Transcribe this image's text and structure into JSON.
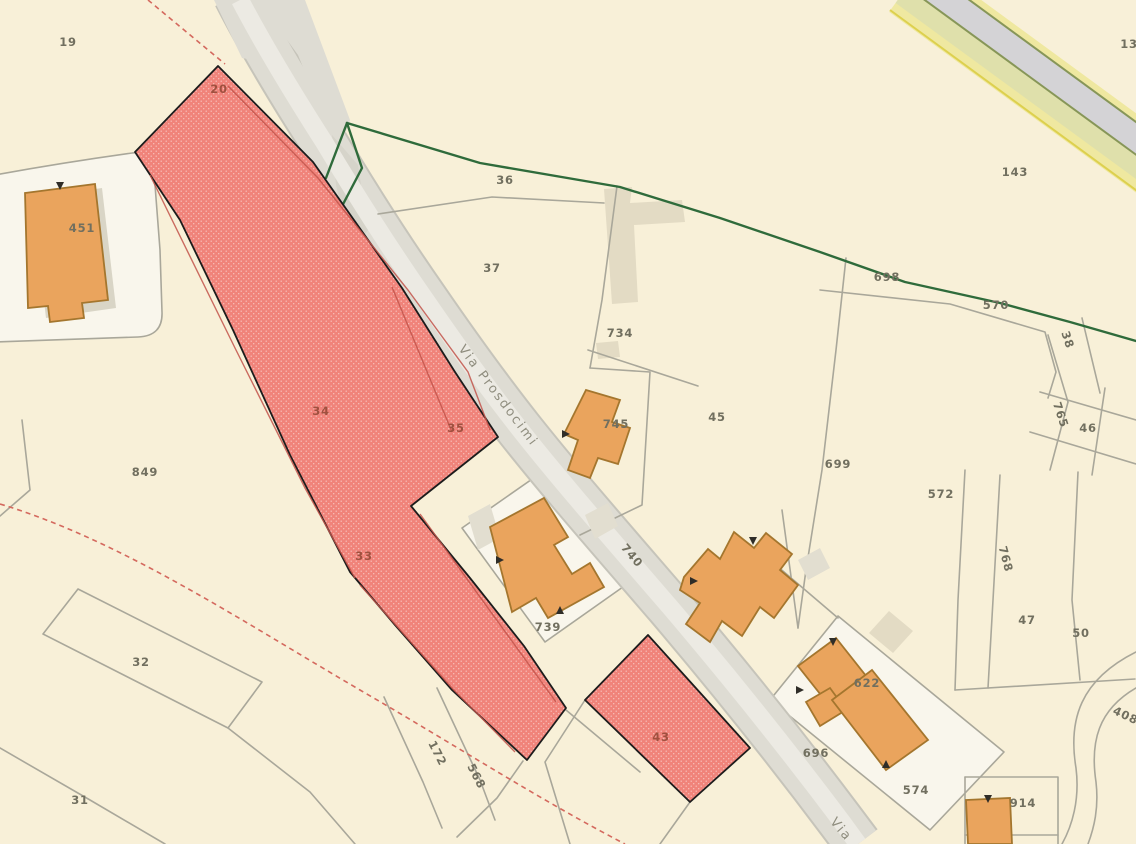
{
  "map": {
    "kind": "cadastral-parcel-map",
    "streets": [
      "Via Prosdocimi",
      "Via"
    ],
    "highlighted_parcels": [
      "20",
      "34",
      "35",
      "33",
      "43"
    ],
    "colors": {
      "background": "#f8f0d8",
      "parcel_light": "#f9f6ec",
      "boundary_grey": "#a9a79a",
      "road_fill": "#dedcd3",
      "road_core": "#eceae3",
      "road_edge": "#c6c4ba",
      "yellow_road_band": "#efe8a0",
      "yellow_road_inner": "#dfe0ab",
      "hedge_green": "#2f6b3b",
      "dashed_red": "#d4695e",
      "highlight_fill": "#f0837a",
      "highlight_stroke": "#1c1c1c",
      "highlight_inner": "#c2544a",
      "building_fill": "#eaa45d",
      "building_stroke": "#a4762e",
      "tan_building": "#e3dbc4",
      "annex_grey": "#e2ded0",
      "label_grey": "#716f5f",
      "label_red": "#a0503f",
      "street_label": "#8f8d7e"
    },
    "labels": [
      {
        "text": "19",
        "x": 68,
        "y": 46
      },
      {
        "text": "13",
        "x": 1129,
        "y": 48
      },
      {
        "text": "143",
        "x": 1015,
        "y": 176
      },
      {
        "text": "451",
        "x": 82,
        "y": 232
      },
      {
        "text": "36",
        "x": 505,
        "y": 184
      },
      {
        "text": "37",
        "x": 492,
        "y": 272
      },
      {
        "text": "734",
        "x": 620,
        "y": 337
      },
      {
        "text": "745",
        "x": 616,
        "y": 428
      },
      {
        "text": "45",
        "x": 717,
        "y": 421
      },
      {
        "text": "698",
        "x": 887,
        "y": 281
      },
      {
        "text": "570",
        "x": 996,
        "y": 309
      },
      {
        "text": "38",
        "x": 1064,
        "y": 341,
        "rot": 72
      },
      {
        "text": "765",
        "x": 1057,
        "y": 416,
        "rot": 72
      },
      {
        "text": "46",
        "x": 1088,
        "y": 432
      },
      {
        "text": "699",
        "x": 838,
        "y": 468
      },
      {
        "text": "572",
        "x": 941,
        "y": 498
      },
      {
        "text": "768",
        "x": 1002,
        "y": 560,
        "rot": 75
      },
      {
        "text": "47",
        "x": 1027,
        "y": 624
      },
      {
        "text": "50",
        "x": 1081,
        "y": 637
      },
      {
        "text": "849",
        "x": 145,
        "y": 476
      },
      {
        "text": "32",
        "x": 141,
        "y": 666
      },
      {
        "text": "31",
        "x": 80,
        "y": 804
      },
      {
        "text": "739",
        "x": 548,
        "y": 631
      },
      {
        "text": "696",
        "x": 816,
        "y": 757
      },
      {
        "text": "622",
        "x": 867,
        "y": 687
      },
      {
        "text": "574",
        "x": 916,
        "y": 794
      },
      {
        "text": "914",
        "x": 1023,
        "y": 807
      },
      {
        "text": "408",
        "x": 1124,
        "y": 719,
        "rot": 25
      },
      {
        "text": "172",
        "x": 434,
        "y": 755,
        "rot": 63
      },
      {
        "text": "568",
        "x": 473,
        "y": 778,
        "rot": 63
      },
      {
        "text": "740",
        "x": 629,
        "y": 558,
        "rot": 50
      },
      {
        "text": "20",
        "x": 219,
        "y": 93,
        "cls": "selected",
        "size": 10
      },
      {
        "text": "34",
        "x": 321,
        "y": 415,
        "cls": "selected"
      },
      {
        "text": "35",
        "x": 456,
        "y": 432,
        "cls": "selected"
      },
      {
        "text": "33",
        "x": 364,
        "y": 560,
        "cls": "selected"
      },
      {
        "text": "43",
        "x": 661,
        "y": 741,
        "cls": "selected"
      },
      {
        "text": "Via Prosdocimi",
        "x": 495,
        "y": 398,
        "rot": 53,
        "cls": "street"
      },
      {
        "text": "Via",
        "x": 838,
        "y": 832,
        "rot": 50,
        "cls": "street"
      }
    ]
  }
}
